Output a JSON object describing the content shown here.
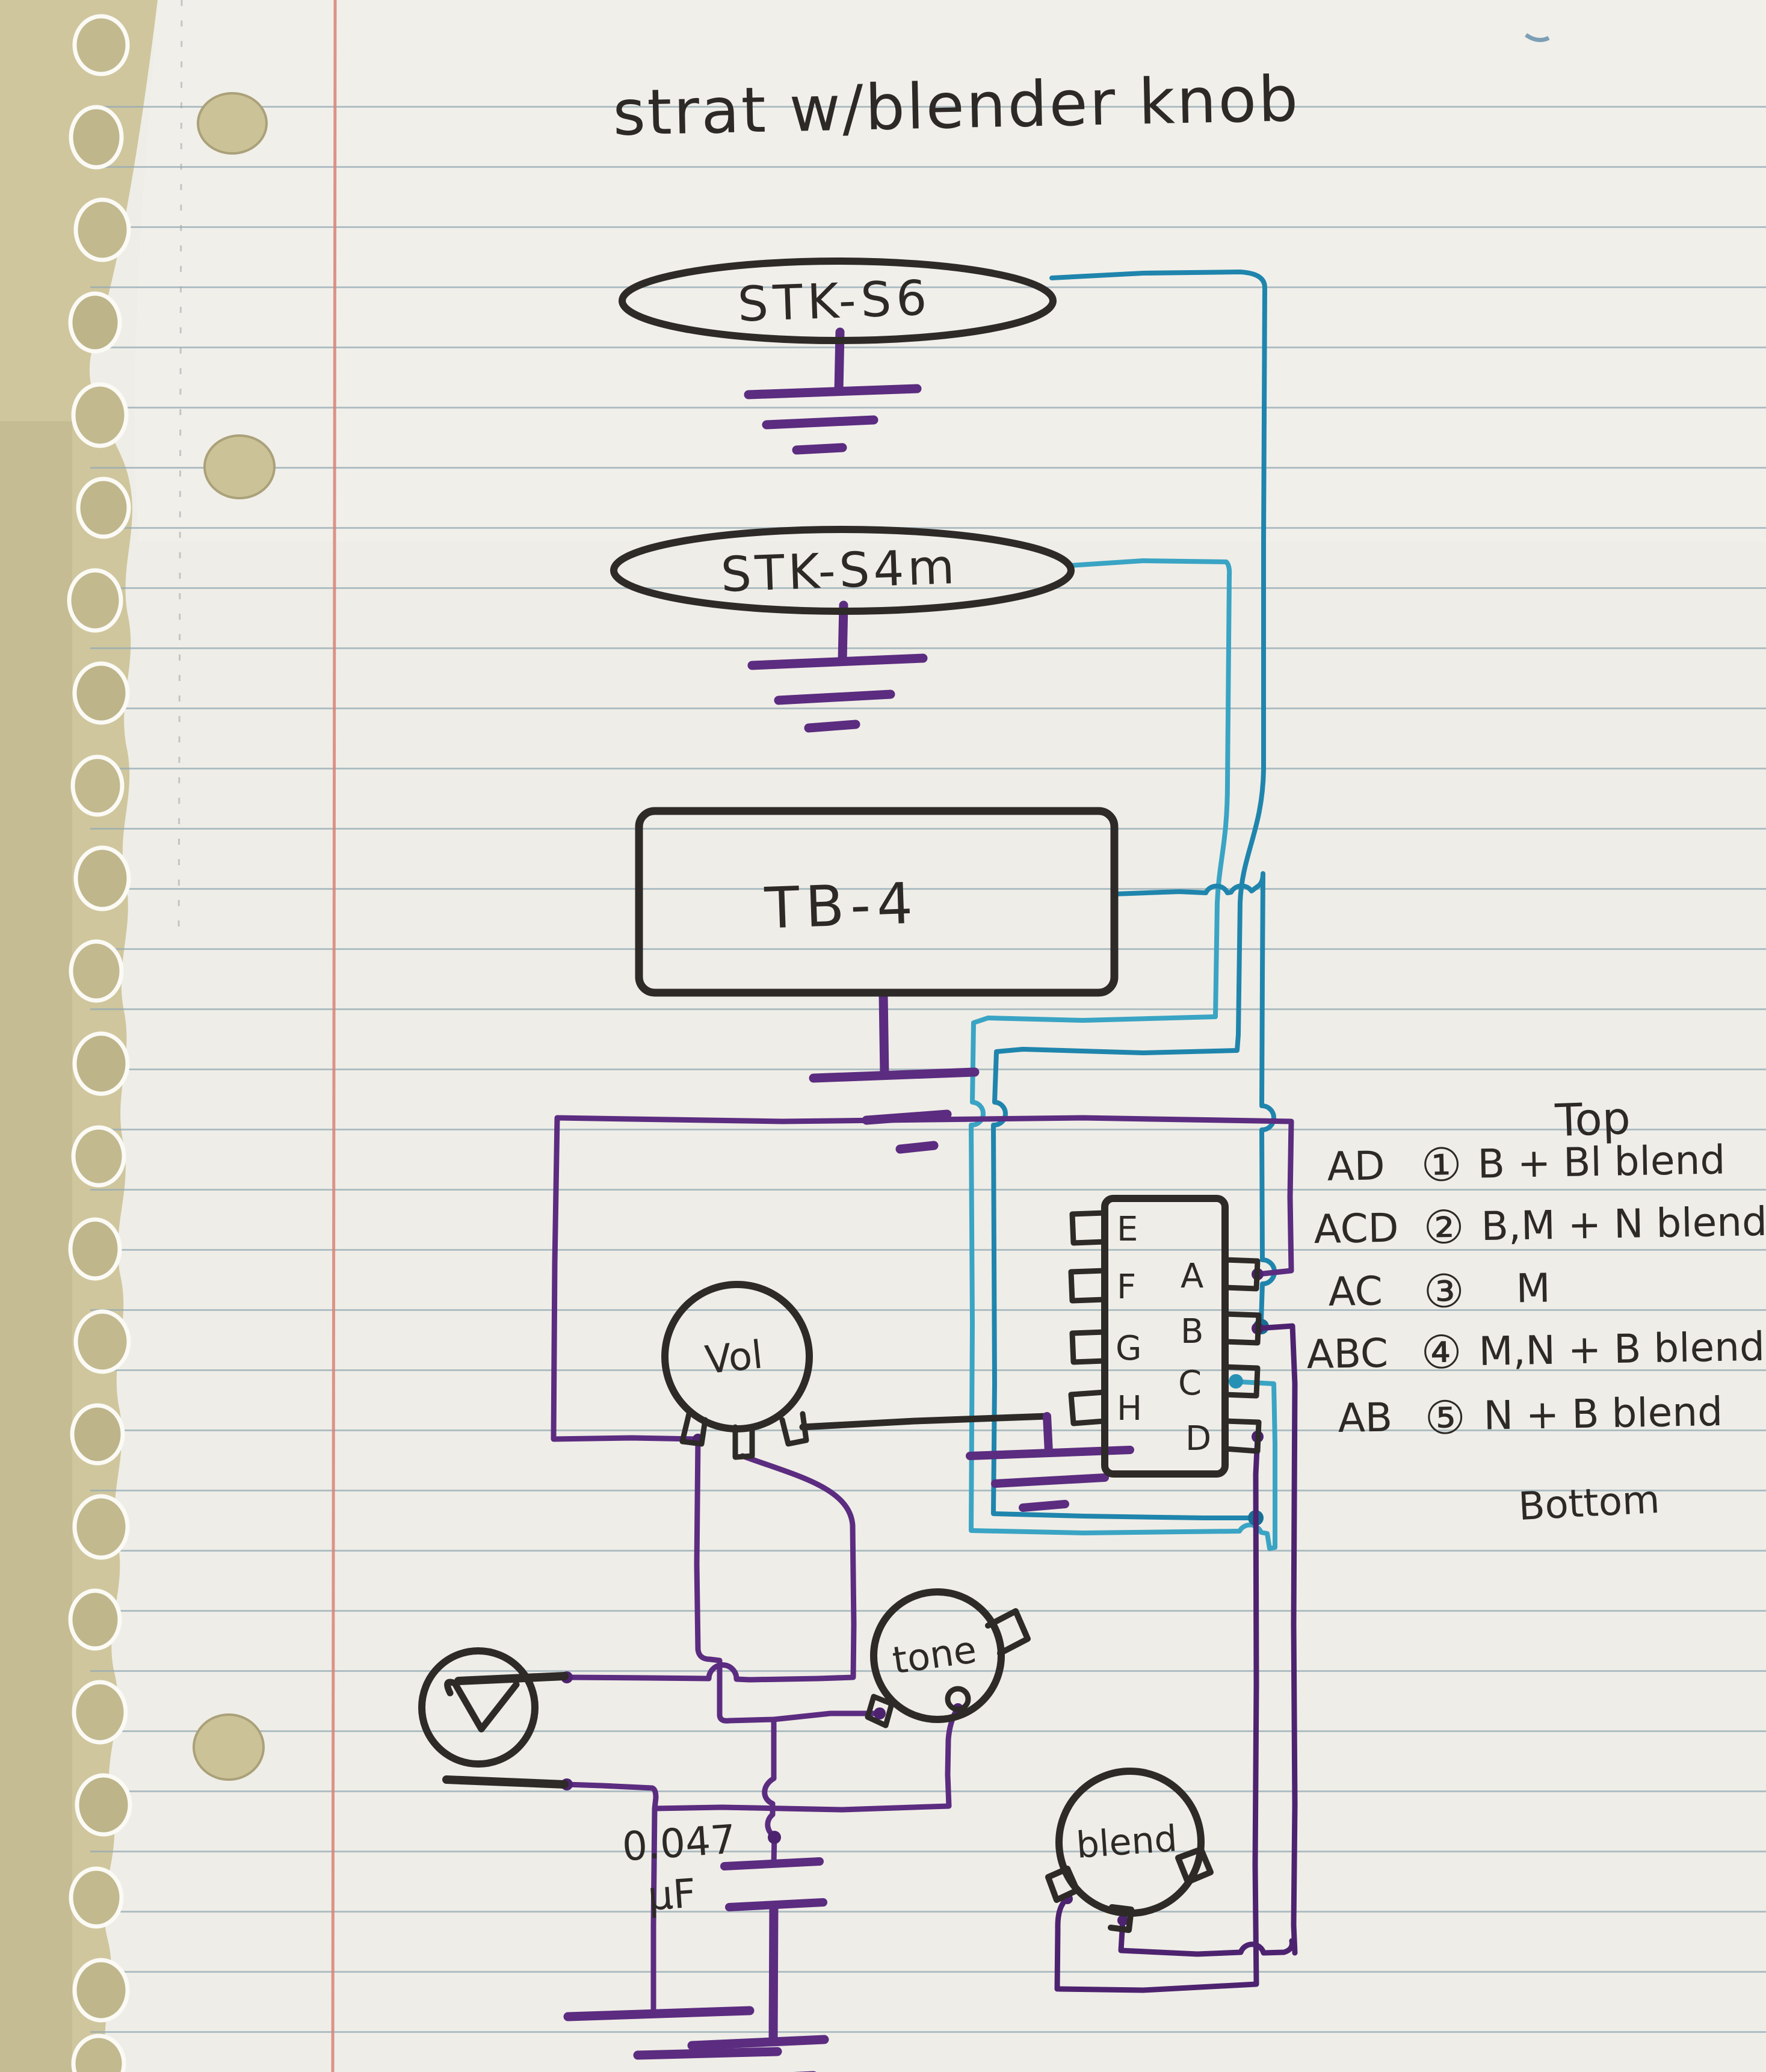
{
  "title": "strat w/blender knob",
  "pickups": [
    {
      "label": "STK-S6"
    },
    {
      "label": "STK-S4m"
    },
    {
      "label": "TB-4"
    }
  ],
  "pots": {
    "volume_label": "Vol",
    "tone_label": "tone",
    "blend_label": "blend"
  },
  "capacitor": {
    "value": "0.047",
    "unit": "µF"
  },
  "selector_switch": {
    "left_lugs": [
      "E",
      "F",
      "G",
      "H"
    ],
    "right_lugs": [
      "A",
      "B",
      "C",
      "D"
    ]
  },
  "legend": {
    "top_label": "Top",
    "bottom_label": "Bottom",
    "rows": [
      {
        "lugs": "AD",
        "position": "①",
        "description": "B + Bl blend"
      },
      {
        "lugs": "ACD",
        "position": "②",
        "description": "B,M + N blend"
      },
      {
        "lugs": "AC",
        "position": "③",
        "description": "M"
      },
      {
        "lugs": "ABC",
        "position": "④",
        "description": "M,N + B blend"
      },
      {
        "lugs": "AB",
        "position": "⑤",
        "description": "N + B blend"
      }
    ]
  },
  "colors": {
    "paper": "#efede7",
    "desk": "#cfc69d",
    "rule_line": "#93a9b4",
    "margin_line": "#d98477",
    "ink_black": "#2d2a27",
    "ink_purple": "#5b2c80",
    "ink_teal": "#1f85ad"
  }
}
